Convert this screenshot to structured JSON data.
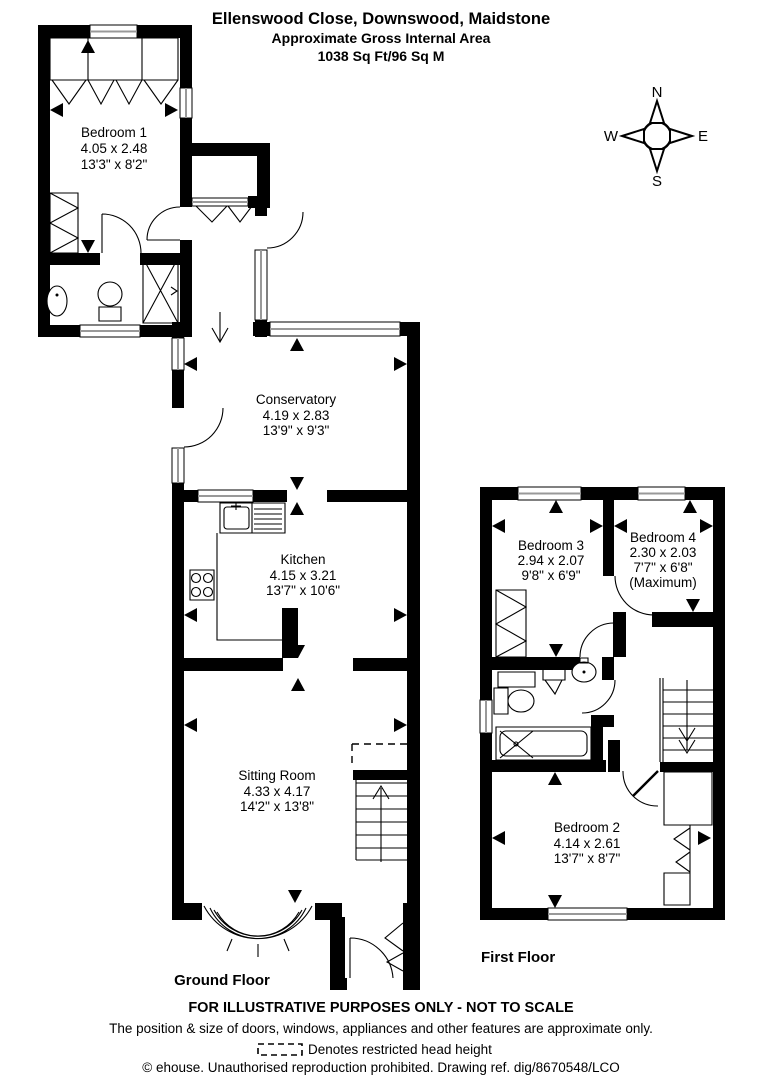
{
  "header": {
    "title": "Ellenswood Close, Downswood, Maidstone",
    "subtitle": "Approximate Gross Internal Area",
    "area": "1038 Sq Ft/96 Sq M"
  },
  "compass": {
    "n": "N",
    "e": "E",
    "s": "S",
    "w": "W"
  },
  "ground": {
    "label": "Ground Floor",
    "rooms": {
      "bedroom1": {
        "name": "Bedroom 1",
        "metric": "4.05 x 2.48",
        "imperial": "13'3\" x 8'2\""
      },
      "conservatory": {
        "name": "Conservatory",
        "metric": "4.19 x 2.83",
        "imperial": "13'9\" x 9'3\""
      },
      "kitchen": {
        "name": "Kitchen",
        "metric": "4.15 x 3.21",
        "imperial": "13'7\" x 10'6\""
      },
      "sitting_room": {
        "name": "Sitting Room",
        "metric": "4.33 x 4.17",
        "imperial": "14'2\" x 13'8\""
      }
    }
  },
  "first": {
    "label": "First Floor",
    "rooms": {
      "bedroom3": {
        "name": "Bedroom 3",
        "metric": "2.94 x 2.07",
        "imperial": "9'8\" x 6'9\""
      },
      "bedroom4": {
        "name": "Bedroom 4",
        "metric": "2.30 x 2.03",
        "imperial": "7'7\" x 6'8\"",
        "note": "(Maximum)"
      },
      "bedroom2": {
        "name": "Bedroom 2",
        "metric": "4.14 x 2.61",
        "imperial": "13'7\" x 8'7\""
      }
    }
  },
  "footer": {
    "line1": "FOR ILLUSTRATIVE PURPOSES ONLY - NOT TO SCALE",
    "line2": "The position & size of doors, windows, appliances and other features are approximate only.",
    "line3": "Denotes restricted head height",
    "line4": "© ehouse. Unauthorised reproduction prohibited. Drawing ref. dig/8670548/LCO"
  },
  "colors": {
    "wall": "#000000",
    "window_stripe": "#999999",
    "background": "#ffffff"
  }
}
